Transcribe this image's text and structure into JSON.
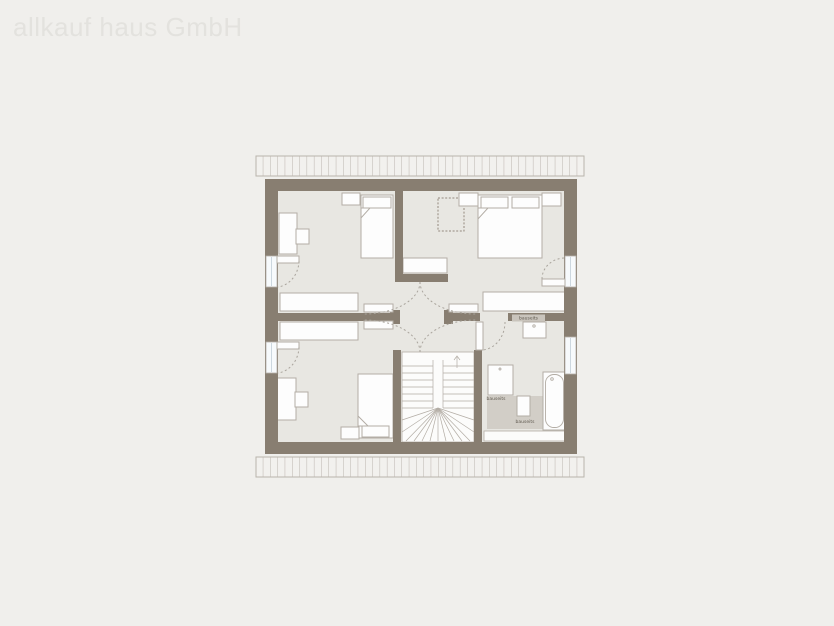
{
  "watermark": {
    "text": "allkauf haus GmbH"
  },
  "floor_plan": {
    "annotations": {
      "washbasin_label": "bauseits",
      "shower_label": "bauseits",
      "bath_floor_label": "bauseits"
    },
    "colors": {
      "page_background": "#f0efec",
      "wall": "#887e71",
      "room_floor": "#e8e7e2",
      "furniture_fill": "#fdfdfd",
      "furniture_outline": "#b3ada5",
      "bath_tiled_floor": "#d2cec7",
      "window_glass": "#f7fafc",
      "swing_arc": "#a9a49c",
      "watermark_text": "#e3e2de"
    }
  }
}
